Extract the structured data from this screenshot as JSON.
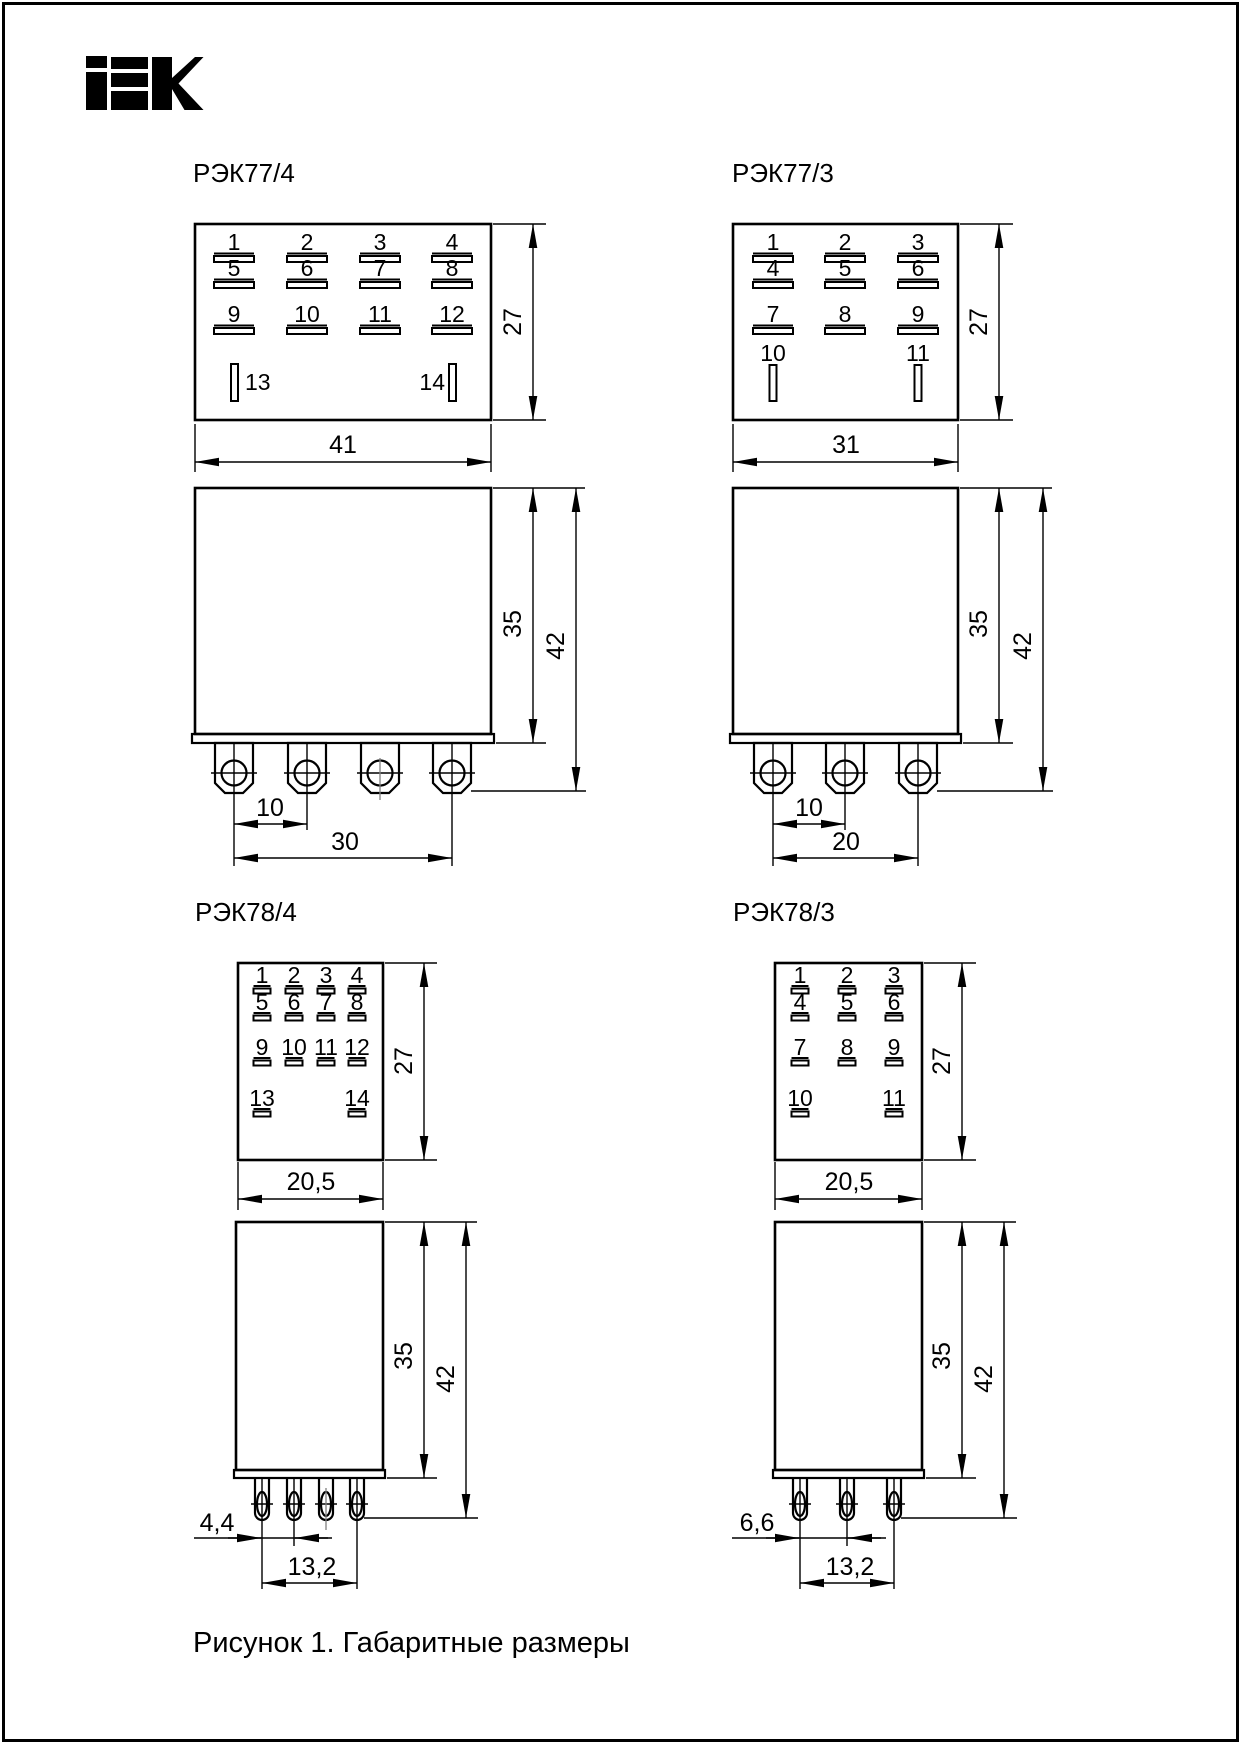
{
  "logo": {
    "brand": "IEK"
  },
  "caption": "Рисунок 1. Габаритные размеры",
  "diagrams": {
    "rek77_4": {
      "title": "РЭК77/4",
      "pins": [
        "1",
        "2",
        "3",
        "4",
        "5",
        "6",
        "7",
        "8",
        "9",
        "10",
        "11",
        "12"
      ],
      "aux_pins": [
        "13",
        "14"
      ],
      "dims": {
        "width": "41",
        "height": "27",
        "body_height": "35",
        "total_height": "42",
        "pin_pitch": "10",
        "pin_span": "30"
      }
    },
    "rek77_3": {
      "title": "РЭК77/3",
      "pins": [
        "1",
        "2",
        "3",
        "4",
        "5",
        "6",
        "7",
        "8",
        "9"
      ],
      "aux_pins": [
        "10",
        "11"
      ],
      "dims": {
        "width": "31",
        "height": "27",
        "body_height": "35",
        "total_height": "42",
        "pin_pitch": "10",
        "pin_span": "20"
      }
    },
    "rek78_4": {
      "title": "РЭК78/4",
      "pins": [
        "1",
        "2",
        "3",
        "4",
        "5",
        "6",
        "7",
        "8",
        "9",
        "10",
        "11",
        "12"
      ],
      "aux_pins": [
        "13",
        "14"
      ],
      "dims": {
        "width": "20,5",
        "height": "27",
        "body_height": "35",
        "total_height": "42",
        "pin_pitch": "4,4",
        "pin_span": "13,2"
      }
    },
    "rek78_3": {
      "title": "РЭК78/3",
      "pins": [
        "1",
        "2",
        "3",
        "4",
        "5",
        "6",
        "7",
        "8",
        "9"
      ],
      "aux_pins": [
        "10",
        "11"
      ],
      "dims": {
        "width": "20,5",
        "height": "27",
        "body_height": "35",
        "total_height": "42",
        "pin_pitch": "6,6",
        "pin_span": "13,2"
      }
    }
  }
}
